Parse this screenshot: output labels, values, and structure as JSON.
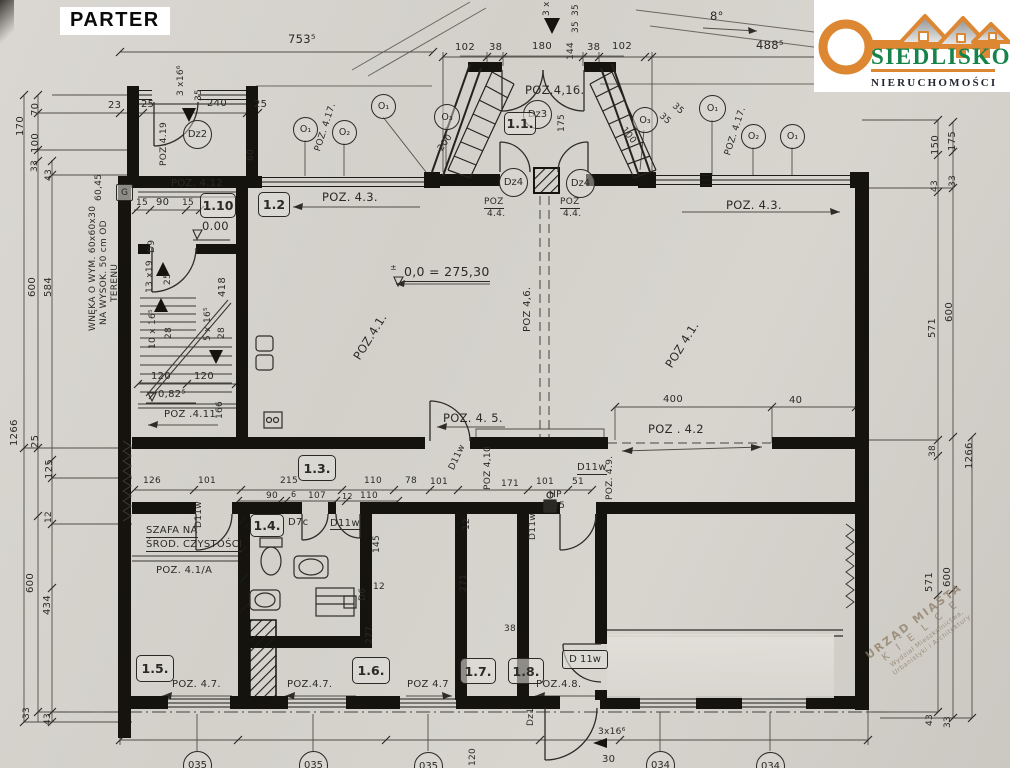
{
  "title": "PARTER",
  "logo": {
    "brand": "SIEDLISKO",
    "subtitle": "NIERUCHOMOŚCI",
    "accent": "#dd8732",
    "green": "#16844a"
  },
  "stamp": {
    "l1": "URZĄD MIASTA",
    "l2": "K I E L C E",
    "l3": "Wydział Mieszkalnictwa,",
    "l4": "Urbanistyki i Architektury"
  },
  "rooms": {
    "r11": "1.1.",
    "r12": "1.2",
    "r110": "1.10",
    "r13": "1.3.",
    "r14": "1.4.",
    "r15": "1.5.",
    "r16": "1.6.",
    "r17": "1.7.",
    "r18": "1.8."
  },
  "doors": {
    "dz1": "Dz1",
    "dz2": "Dz2",
    "dz3": "Dz3",
    "dz4": "Dz4",
    "d9": "D9",
    "d7c": "D7c",
    "d6": "D6",
    "d11w": "D11w",
    "d11ws": "D 11w"
  },
  "axes": {
    "o1": "O₁",
    "o2": "O₂",
    "o3": "O₃"
  },
  "poz": {
    "p41": "POZ.4.1.",
    "p41b": "POZ 4.1.",
    "p41a": "POZ. 4.1/A",
    "p42": "POZ . 4.2",
    "p43": "POZ. 4.3.",
    "p44a": "POZ",
    "p44b": "4.4.",
    "p45": "POZ. 4. 5.",
    "p46": "POZ 4,6.",
    "p47": "POZ. 4.7.",
    "p47b": "POZ.4.7.",
    "p47c": "POZ 4.7",
    "p48": "POZ.4.8.",
    "p49": "POZ. 4.9.",
    "p410": "POZ 4,10",
    "p411": "POZ .4.11",
    "p412": "POZ. 4.12",
    "p416": "POZ.4,16.",
    "p417": "POZ. 4.17.",
    "p419": "POZ.4.19"
  },
  "levels": {
    "zero": "0.00",
    "datum": "0,0 = 275,30",
    "pm": "±",
    "l082": "0,82⁵"
  },
  "notes": {
    "wneka1": "WNĘKA O WYM. 60x60x30",
    "wneka2": "NA WYSOK. 50 cm OD",
    "wneka3": "TERENU",
    "szafa1": "SZAFA NA",
    "szafa2": "ŚROD. CZYSTOŚCI",
    "g": "G",
    "hp": "HP",
    "fi25": "∅25"
  },
  "stairs": {
    "s3x16": "3 x16⁶",
    "s3x": "3 x",
    "s13x19": "13 x19",
    "s10x16": "10 x 16⁵",
    "s5x16": "5 x 16⁵",
    "s3x16b": "3x16⁶",
    "s30": "30"
  },
  "marks": {
    "c035": "035",
    "c034": "034"
  },
  "dims": {
    "d6": "6",
    "d8deg": "8°",
    "d12": "12",
    "d15": "15",
    "d23": "23",
    "d25": "25",
    "d28": "28",
    "d33": "33",
    "d35": "35",
    "d38": "38",
    "d40": "40",
    "d43": "43",
    "d51": "51",
    "d60": "60",
    "d6045": "60,45",
    "d70": "70",
    "d78": "78",
    "d90": "90",
    "d100": "100",
    "d101": "101",
    "d102": "102",
    "d107": "107",
    "d110": "110",
    "d120": "120",
    "d125": "125",
    "d126": "126",
    "d144": "144",
    "d145": "145",
    "d150": "150",
    "d166": "166",
    "d170": "170",
    "d171": "171",
    "d175": "175",
    "d180": "180",
    "d200": "200",
    "d215": "215",
    "d240": "240",
    "d271": "271",
    "d277": "277",
    "d400": "400",
    "d418": "418",
    "d434": "434",
    "d488": "488⁵",
    "d571": "571",
    "d584": "584",
    "d600": "600",
    "d753": "753⁵",
    "d1266": "1266"
  }
}
